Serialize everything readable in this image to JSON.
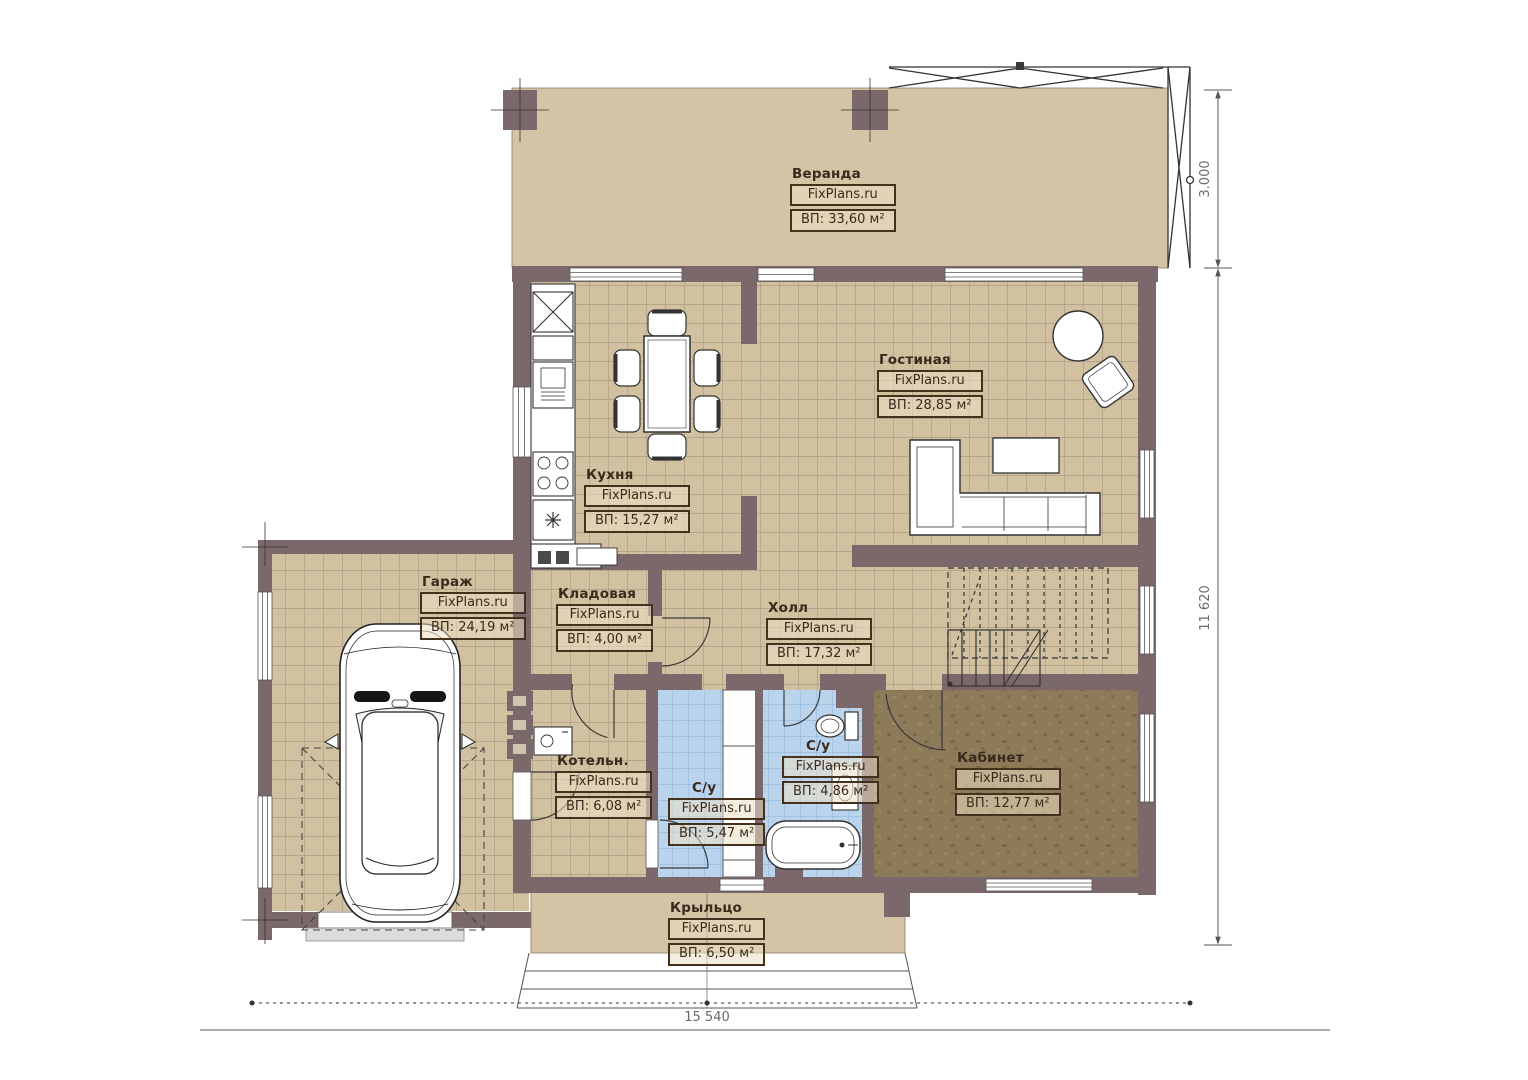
{
  "brand": "FixPlans.ru",
  "plan": {
    "rooms": [
      {
        "id": "veranda",
        "name": "Веранда",
        "area": "ВП: 33,60 м²"
      },
      {
        "id": "livingroom",
        "name": "Гостиная",
        "area": "ВП: 28,85 м²"
      },
      {
        "id": "kitchen",
        "name": "Кухня",
        "area": "ВП: 15,27 м²"
      },
      {
        "id": "garage",
        "name": "Гараж",
        "area": "ВП: 24,19 м²"
      },
      {
        "id": "storage",
        "name": "Кладовая",
        "area": "ВП: 4,00 м²"
      },
      {
        "id": "hall",
        "name": "Холл",
        "area": "ВП: 17,32 м²"
      },
      {
        "id": "boiler",
        "name": "Котельн.",
        "area": "ВП: 6,08 м²"
      },
      {
        "id": "wc1",
        "name": "С/у",
        "area": "ВП: 5,47 м²"
      },
      {
        "id": "wc2",
        "name": "С/у",
        "area": "ВП: 4,86 м²"
      },
      {
        "id": "office",
        "name": "Кабинет",
        "area": "ВП: 12,77 м²"
      },
      {
        "id": "porch",
        "name": "Крыльцо",
        "area": "ВП: 6,50 м²"
      }
    ],
    "dimensions": {
      "veranda_depth": "3.000",
      "house_depth": "11 620",
      "house_width": "15 540"
    },
    "colors": {
      "wall": "#7b686b",
      "floor_tile": "#d1c1a0",
      "veranda_fill": "#d4c4a5",
      "bath_tile": "#bad4ed",
      "office_floor": "#8d7a58",
      "label_ink": "#43301d"
    }
  }
}
